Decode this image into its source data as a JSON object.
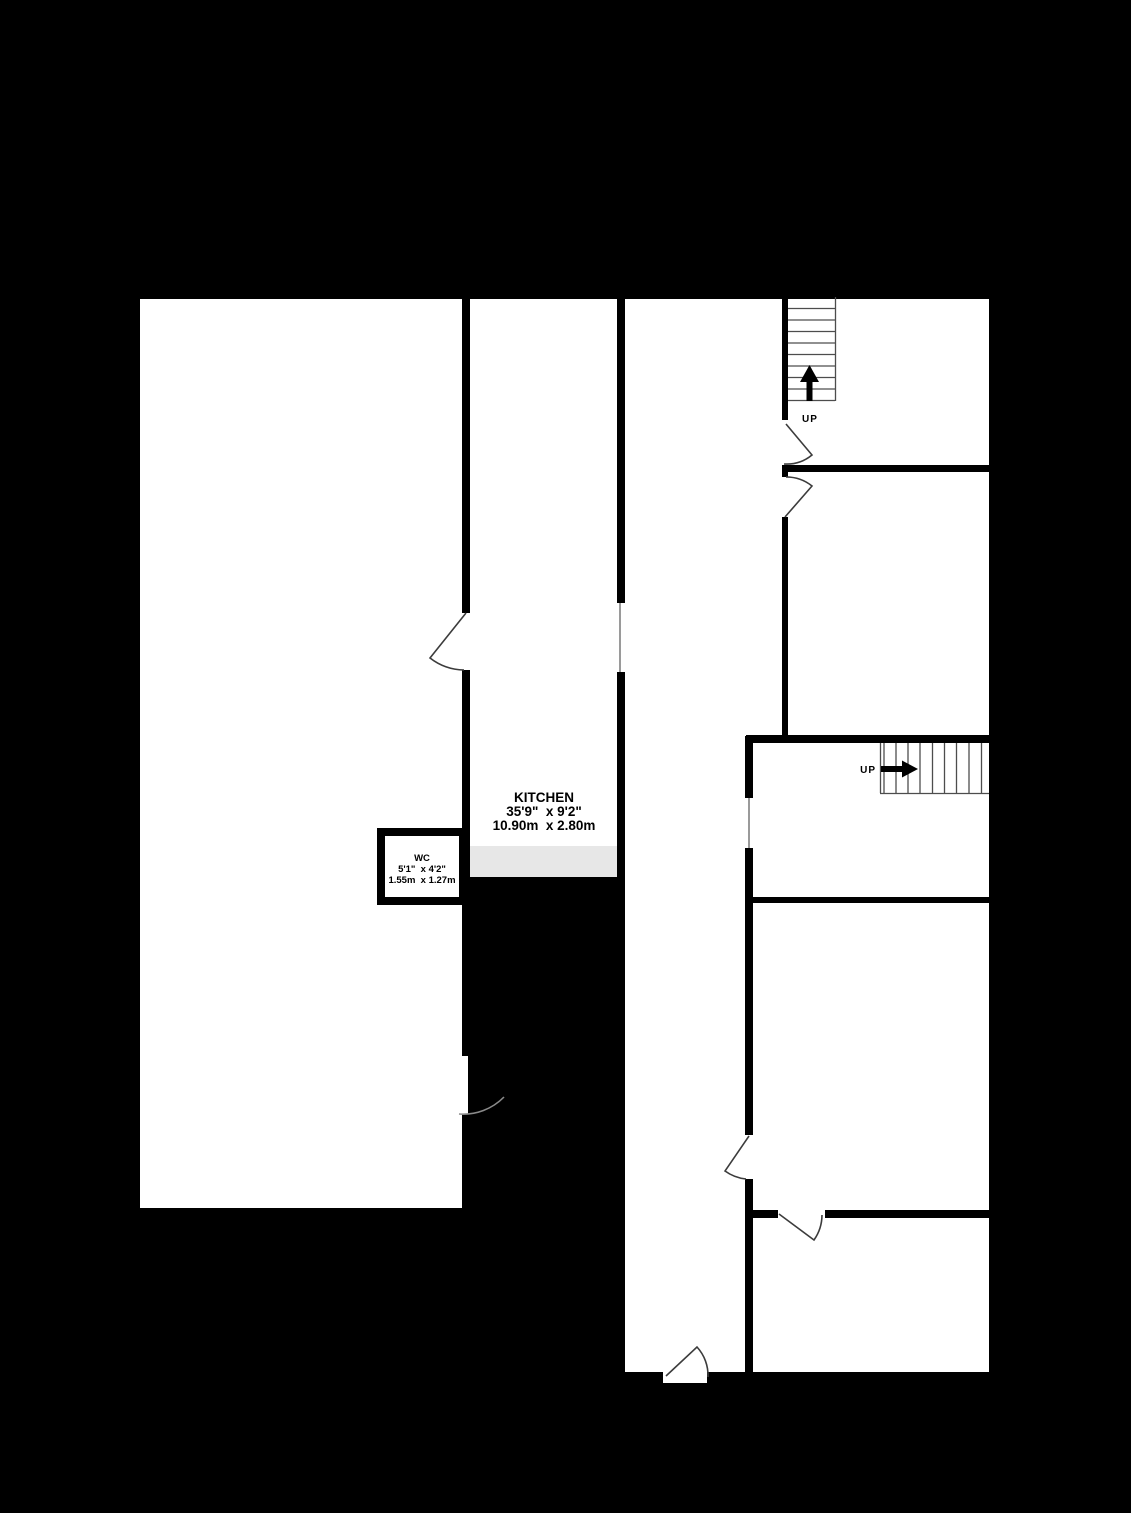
{
  "plan": {
    "type": "floorplan",
    "rooms": [
      {
        "id": "kitchen",
        "name": "KITCHEN",
        "size_imperial": "35'9\"  x 9'2\"",
        "size_metric": "10.90m  x 2.80m"
      },
      {
        "id": "wc",
        "name": "WC",
        "size_imperial": "5'1\"  x 4'2\"",
        "size_metric": "1.55m  x 1.27m"
      }
    ],
    "stairs": [
      {
        "id": "stair-top",
        "label": "UP",
        "direction": "up"
      },
      {
        "id": "stair-right",
        "label": "UP",
        "direction": "right"
      }
    ],
    "colors": {
      "background": "#000000",
      "wall": "#000000",
      "floor": "#ffffff",
      "kitchen_step_area": "#e7e7e7",
      "window_line": "#9a9a9a",
      "door_line": "#3c3c3c",
      "stair_line": "#4d4d4d",
      "text": "#000000"
    }
  }
}
